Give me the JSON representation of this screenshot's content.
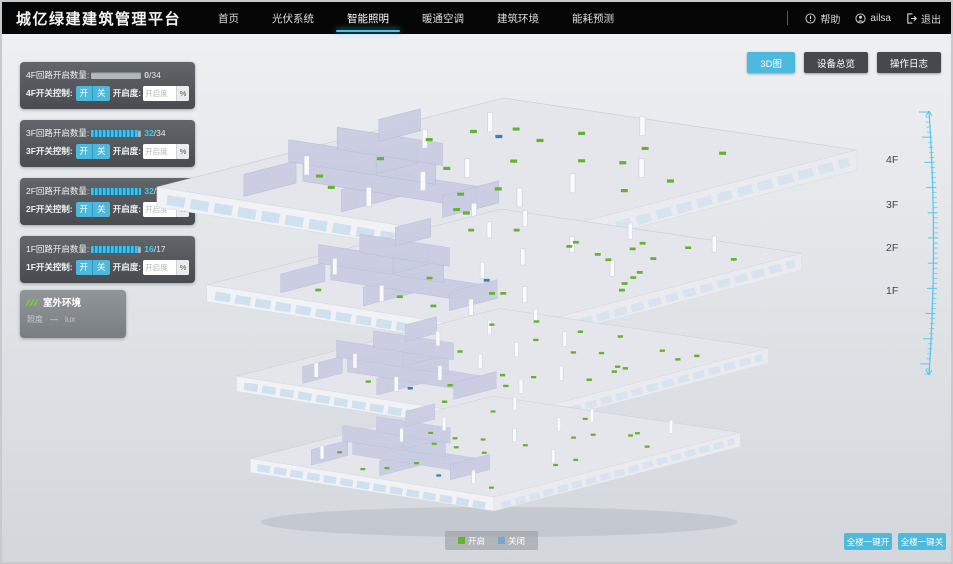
{
  "header": {
    "title": "城亿绿建建筑管理平台",
    "nav": [
      {
        "label": "首页",
        "active": false
      },
      {
        "label": "光伏系统",
        "active": false
      },
      {
        "label": "智能照明",
        "active": true
      },
      {
        "label": "暖通空调",
        "active": false
      },
      {
        "label": "建筑环境",
        "active": false
      },
      {
        "label": "能耗预测",
        "active": false
      }
    ],
    "user": {
      "help_label": "帮助",
      "username": "ailsa",
      "logout_label": "退出"
    }
  },
  "toolbar": {
    "buttons": [
      {
        "label": "3D图",
        "active": true
      },
      {
        "label": "设备总览",
        "active": false
      },
      {
        "label": "操作日志",
        "active": false
      }
    ]
  },
  "floor_panels": [
    {
      "floor": "4F",
      "circuit_label": "4F回路开启数量:",
      "open_text": "0",
      "total_text": "/34",
      "progress_pct": 0,
      "value_color": "#d9dde0",
      "control_label": "4F开关控制:",
      "on_label": "开",
      "off_label": "关",
      "dim_label": "开启度:",
      "dim_placeholder": "开启度",
      "percent_label": "%"
    },
    {
      "floor": "3F",
      "circuit_label": "3F回路开启数量:",
      "open_text": "32",
      "total_text": "/34",
      "progress_pct": 94,
      "value_color": "#3ecdef",
      "control_label": "3F开关控制:",
      "on_label": "开",
      "off_label": "关",
      "dim_label": "开启度:",
      "dim_placeholder": "开启度",
      "percent_label": "%"
    },
    {
      "floor": "2F",
      "circuit_label": "2F回路开启数量:",
      "open_text": "32",
      "total_text": "/32",
      "progress_pct": 100,
      "value_color": "#3ecdef",
      "control_label": "2F开关控制:",
      "on_label": "开",
      "off_label": "关",
      "dim_label": "开启度:",
      "dim_placeholder": "开启度",
      "percent_label": "%"
    },
    {
      "floor": "1F",
      "circuit_label": "1F回路开启数量:",
      "open_text": "16",
      "total_text": "/17",
      "progress_pct": 94,
      "value_color": "#3ecdef",
      "control_label": "1F开关控制:",
      "on_label": "开",
      "off_label": "关",
      "dim_label": "开启度:",
      "dim_placeholder": "开启度",
      "percent_label": "%"
    }
  ],
  "outdoor_panel": {
    "title": "室外环境",
    "metric_label": "照度",
    "metric_value": "—",
    "metric_unit": "lux"
  },
  "scene": {
    "floor_labels": [
      "4F",
      "3F",
      "2F",
      "1F"
    ],
    "legend": [
      {
        "label": "开启",
        "color": "#63b32e"
      },
      {
        "label": "关闭",
        "color": "#7ba6c9"
      }
    ]
  },
  "bulk_controls": [
    {
      "label": "全楼一键开"
    },
    {
      "label": "全楼一键关"
    }
  ],
  "colors": {
    "accent": "#4cb9dd",
    "light_on": "#63b32e",
    "light_off": "#3583ad"
  }
}
